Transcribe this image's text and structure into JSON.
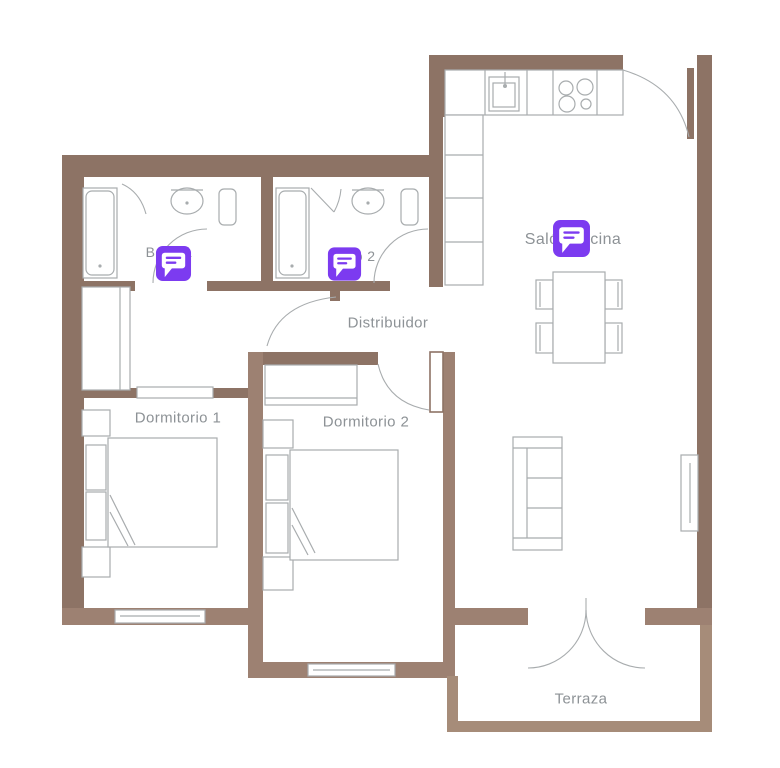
{
  "plan": {
    "title": "Apartment floor plan",
    "rooms": [
      {
        "id": "bano-1",
        "label": "Baño 1"
      },
      {
        "id": "bano-2",
        "label": "Baño 2"
      },
      {
        "id": "distribuidor",
        "label": "Distribuidor"
      },
      {
        "id": "dormitorio-1",
        "label": "Dormitorio 1"
      },
      {
        "id": "dormitorio-2",
        "label": "Dormitorio 2"
      },
      {
        "id": "salon-cocina",
        "label": "Salón cocina"
      },
      {
        "id": "terraza",
        "label": "Terraza"
      }
    ],
    "markers": [
      {
        "icon": "comment-bubble-icon",
        "room_label": "Baño 1"
      },
      {
        "icon": "comment-bubble-icon",
        "room_label": "Baño 2"
      },
      {
        "icon": "comment-bubble-icon",
        "room_label": "Salón cocina"
      }
    ],
    "colors": {
      "wall": "#8d7365",
      "wall_light": "#9d8172",
      "terrace_wall": "#a68c79",
      "fixture_stroke": "#a8acae",
      "label_text": "#8d9296",
      "marker_purple": "#7c3bf0",
      "background": "#ffffff"
    }
  }
}
